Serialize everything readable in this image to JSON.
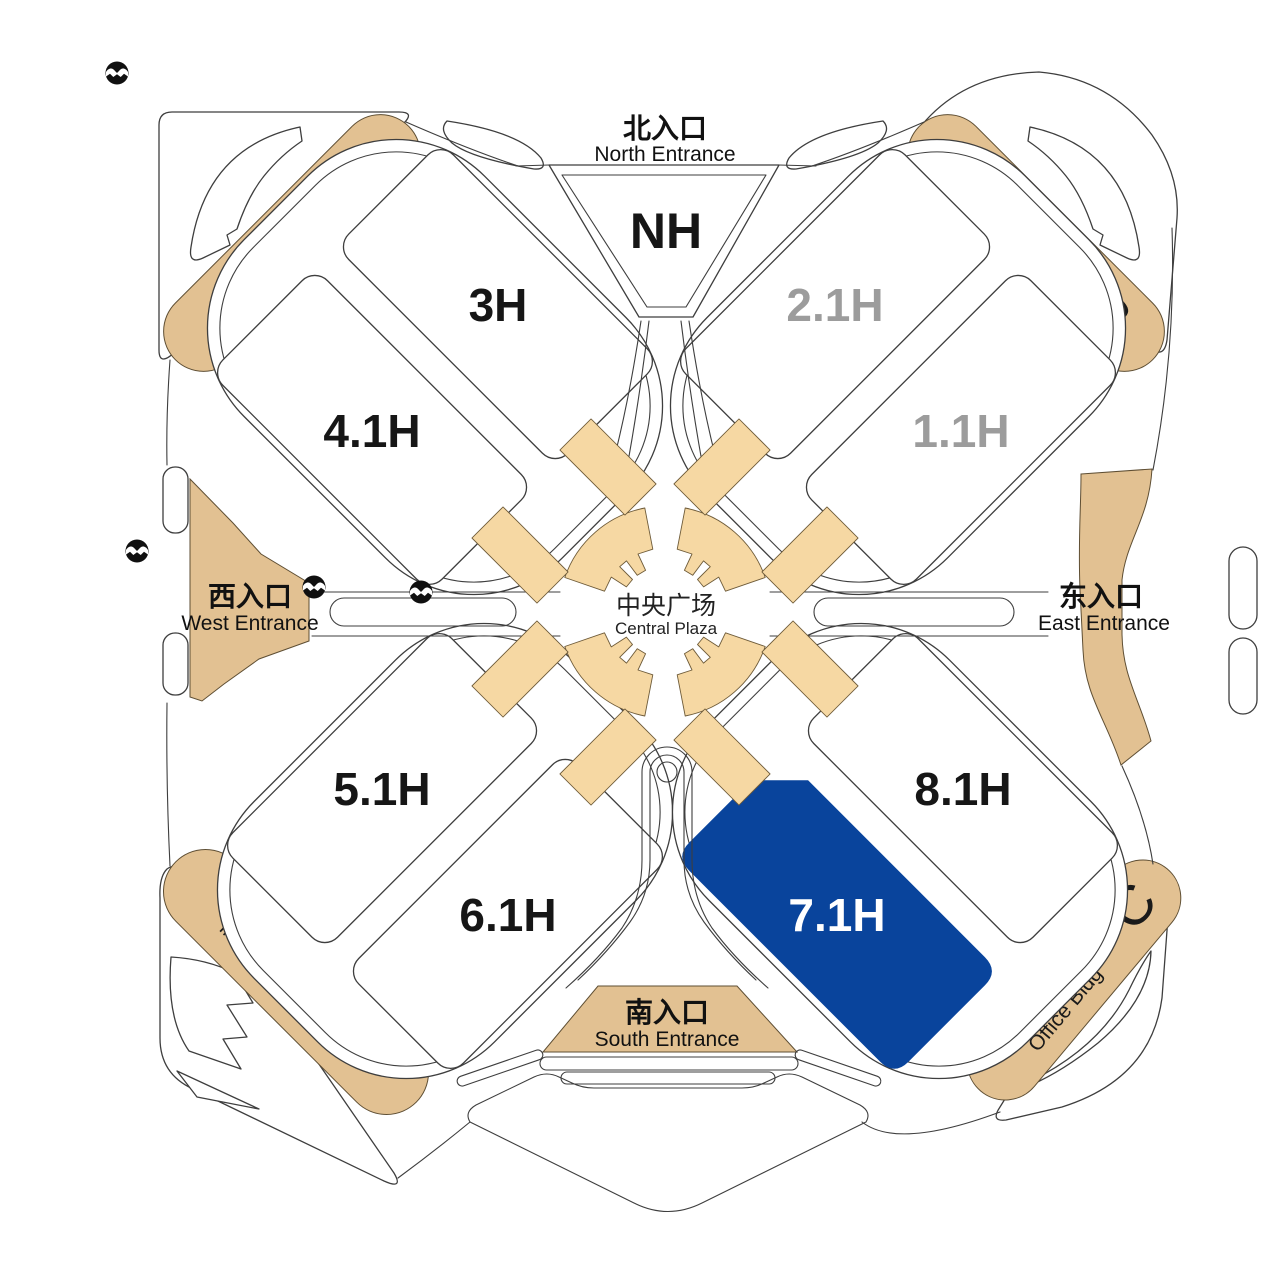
{
  "halls": [
    {
      "id": "nh",
      "label": "NH",
      "state": "normal"
    },
    {
      "id": "3h",
      "label": "3H",
      "state": "normal"
    },
    {
      "id": "21h",
      "label": "2.1H",
      "state": "dimmed"
    },
    {
      "id": "41h",
      "label": "4.1H",
      "state": "normal"
    },
    {
      "id": "11h",
      "label": "1.1H",
      "state": "dimmed"
    },
    {
      "id": "51h",
      "label": "5.1H",
      "state": "normal"
    },
    {
      "id": "81h",
      "label": "8.1H",
      "state": "normal"
    },
    {
      "id": "61h",
      "label": "6.1H",
      "state": "normal"
    },
    {
      "id": "71h",
      "label": "7.1H",
      "state": "highlighted"
    }
  ],
  "entrances": {
    "north": {
      "zh": "北入口",
      "en": "North Entrance"
    },
    "west": {
      "zh": "西入口",
      "en": "West Entrance"
    },
    "east": {
      "zh": "东入口",
      "en": "East Entrance"
    },
    "south": {
      "zh": "南入口",
      "en": "South Entrance"
    }
  },
  "plaza": {
    "zh": "中央广场",
    "en": "Central Plaza"
  },
  "buildings": {
    "office_a": {
      "zh": "办公楼",
      "en": "Office Bldg",
      "letter": "A"
    },
    "office_b": {
      "zh": "办公楼",
      "en": "Office Bldg",
      "letter": "B"
    },
    "office_c": {
      "zh": "办公楼",
      "en": "Office Bldg",
      "letter": "C"
    },
    "hotel": {
      "zh": "洲际酒店",
      "en": "InterContinental Hotel"
    }
  },
  "icons": {
    "metro": "shanghai-metro-logo"
  },
  "colors": {
    "highlight_blue": "#09449C",
    "building_tan": "#E2C192",
    "walkway_tan": "#F6D8A3",
    "dimmed_label_gray": "#9C9C9C",
    "label_black": "#161616",
    "outline_gray": "#3E3E3E",
    "selected_text_white": "#FFFFFF"
  }
}
